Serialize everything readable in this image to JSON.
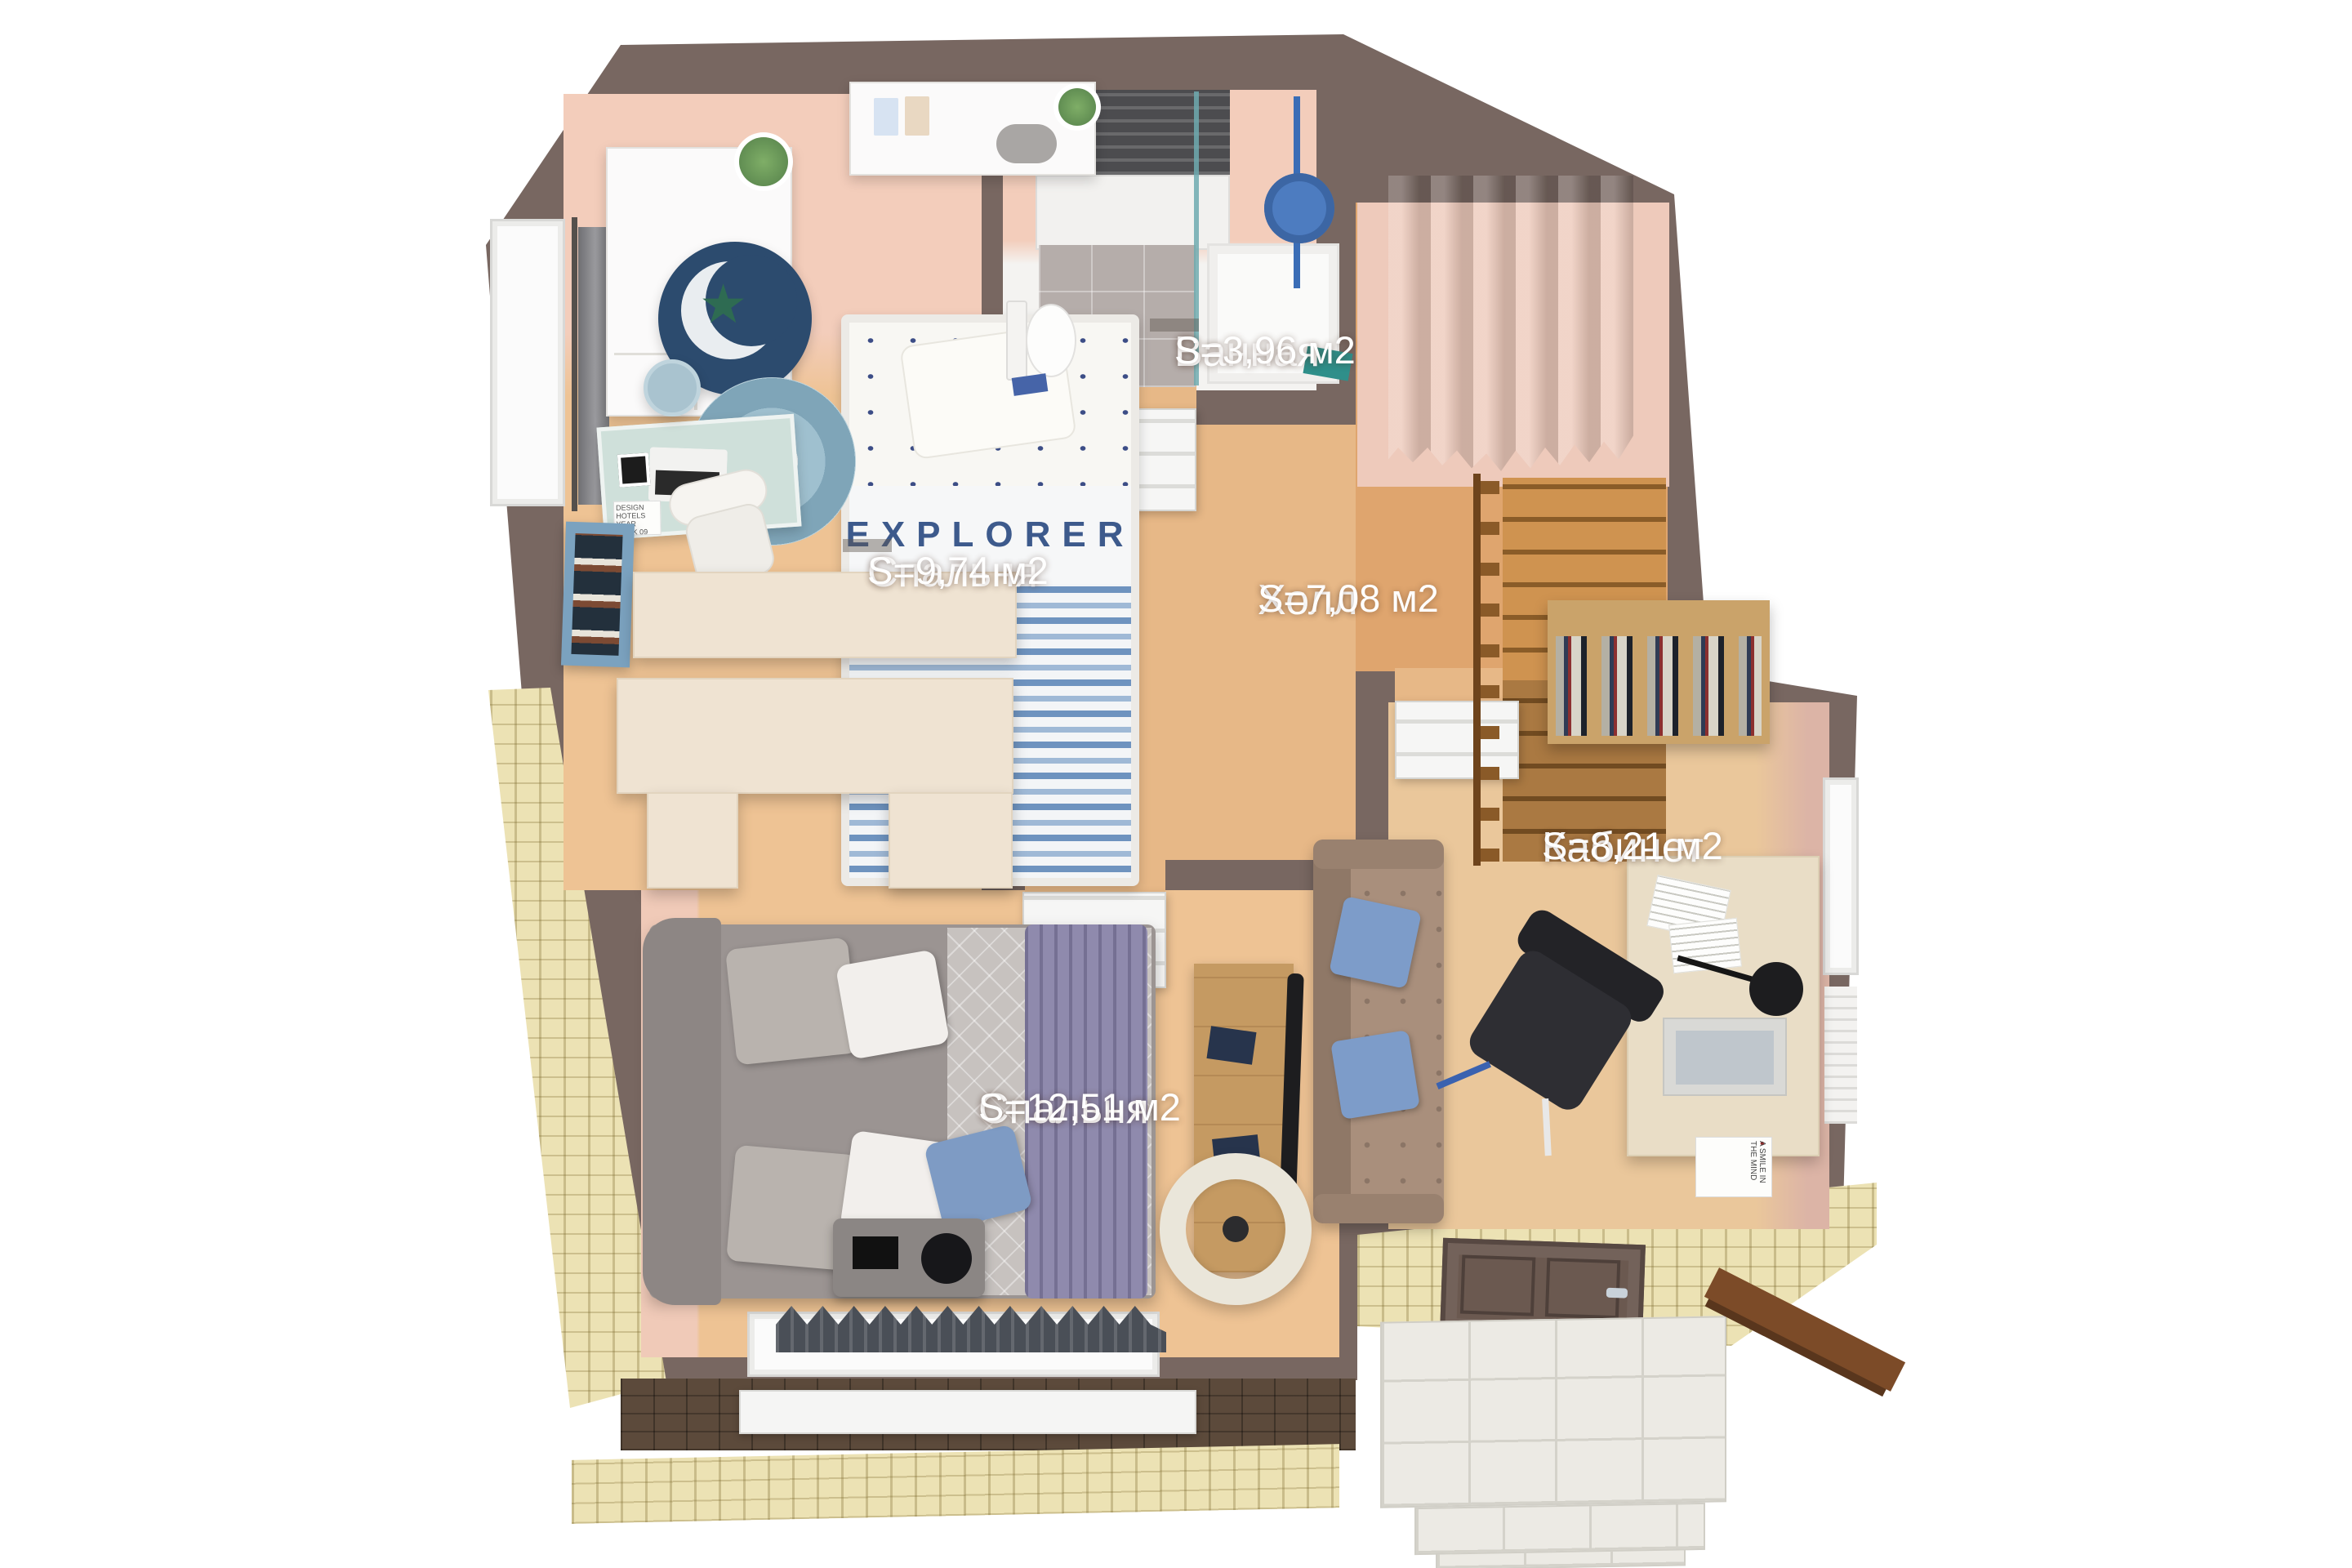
{
  "rooms": [
    {
      "id": "bathroom",
      "name": "Ванная",
      "area": "S=3,96 м2"
    },
    {
      "id": "bedroom-kids",
      "name": "Спальня",
      "area": "S=9,74 м2"
    },
    {
      "id": "hall",
      "name": "Холл",
      "area": "S=7,08 м2"
    },
    {
      "id": "office",
      "name": "Кабинет",
      "area": "S=8,21 м2"
    },
    {
      "id": "bedroom-master",
      "name": "Спальня",
      "area": "S=12,51 м2"
    }
  ],
  "texts": {
    "kids_blanket": "EXPLORER",
    "kids_desk_book": "DESIGN HOTELS YEAR BOOK 09",
    "office_desk_book": "A SMILE IN THE MIND"
  },
  "colors": {
    "wall": "#786761",
    "floor_wood": "#eec394",
    "floor_wood_warm": "#dfa56e",
    "floor_pink": "#f3cdbb",
    "straw": "#ece2b4",
    "shingle": "#5c4a3b",
    "porch": "#eceae4",
    "stairs": "#cf9350",
    "cream": "#efe3d2",
    "sofa": "#a98f7c",
    "pillow_blue": "#7d9cc9",
    "bed_grey": "#9b9492",
    "quilt": "#c7c2bf",
    "runner": "#8f8aad",
    "navy": "#2c4b6e",
    "teal": "#2f8f8a",
    "tv_black": "#1d1d1f",
    "door_brown": "#6b5950",
    "rail_brown": "#7c4b28",
    "label": "#ffffff"
  }
}
